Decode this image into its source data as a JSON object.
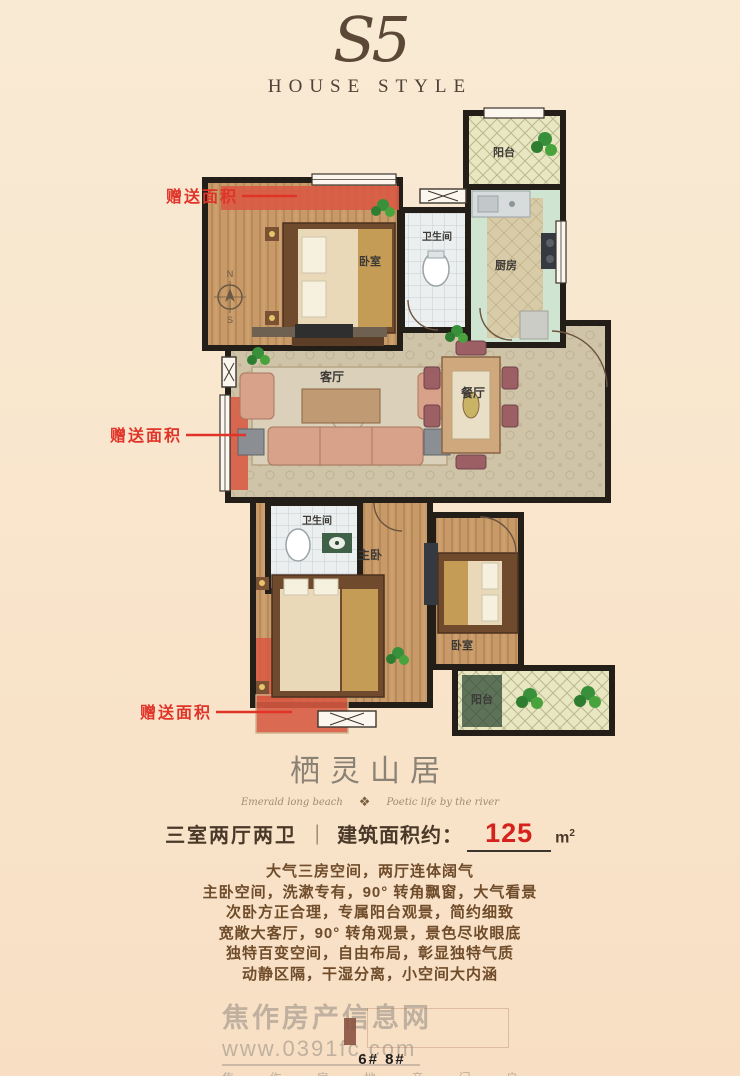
{
  "brand": {
    "mark": "S5",
    "subtitle": "HOUSE STYLE"
  },
  "plan": {
    "rooms": {
      "balcony_top": "阳台",
      "bath_top": "卫生间",
      "kitchen": "厨房",
      "bedroom_top": "卧室",
      "living": "客厅",
      "dining": "餐厅",
      "bath_bottom": "卫生间",
      "master": "主卧",
      "bedroom_bottom": "卧室",
      "balcony_bottom": "阳台"
    },
    "compass": {
      "n": "N",
      "s": "S"
    },
    "gift_labels": [
      "赠送面积",
      "赠送面积",
      "赠送面积"
    ]
  },
  "project": {
    "title": "栖灵山居",
    "tagline_left": "Emerald long beach",
    "ornament": "❖",
    "tagline_right": "Poetic life by the river"
  },
  "spec": {
    "layout": "三室两厅两卫",
    "divider": "｜",
    "area_label": "建筑面积约：",
    "area_value": "125",
    "unit_base": "m",
    "unit_sup": "2"
  },
  "description": {
    "lines": [
      "大气三房空间，两厅连体阔气",
      "主卧空间，洗漱专有，90° 转角飘窗，大气看景",
      "次卧方正合理，专属阳台观景，简约细致",
      "宽敞大客厅，90° 转角观景，景色尽收眼底",
      "独特百变空间，自由布局，彰显独特气质",
      "动静区隔，干湿分离，小空间大内涵"
    ]
  },
  "watermark": {
    "site": "焦作房产信息网",
    "url": "www.0391fc.com",
    "slogan": "焦 作 房 地 产 门 户"
  },
  "footer": {
    "buildings": "6#  8#"
  },
  "colors": {
    "accent_red": "#e03428",
    "gift_area_red": "#d85a42",
    "value_red": "#d6221c",
    "wall_black": "#241e18"
  }
}
